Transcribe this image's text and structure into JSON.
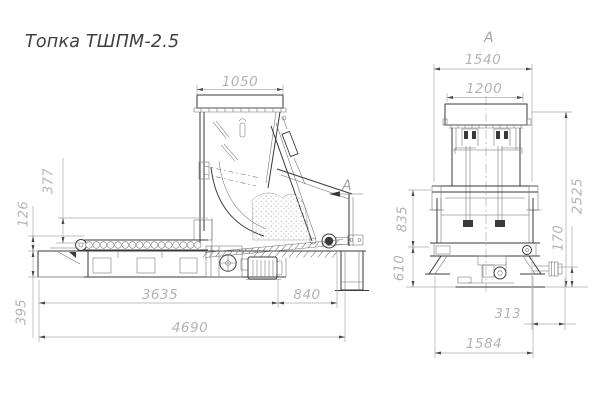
{
  "title": "Топка ТШПМ-2.5",
  "left_view": {
    "section_label": "А",
    "dims": {
      "hopper_top_width": "1050",
      "feed_throat_height": "377",
      "front_ledge_height": "126",
      "pit_depth": "395",
      "conveyor_length": "3635",
      "discharge_overhang": "840",
      "overall_length": "4690"
    }
  },
  "right_view": {
    "view_label": "А",
    "dims": {
      "frame_width": "1540",
      "hopper_width": "1200",
      "upper_height": "835",
      "lower_height": "610",
      "overall_height": "2525",
      "shaft_axis_height": "170",
      "shaft_offset": "313",
      "base_width": "1584"
    }
  },
  "colors": {
    "outline": "#3a3a3a",
    "thin_detail": "#6e6e6e",
    "dimension_line": "#aaaaaa",
    "dimension_text": "#b3b3b3",
    "arrowhead": "#4a4a4a",
    "title_text": "#3f3f3f",
    "background": "#ffffff"
  }
}
